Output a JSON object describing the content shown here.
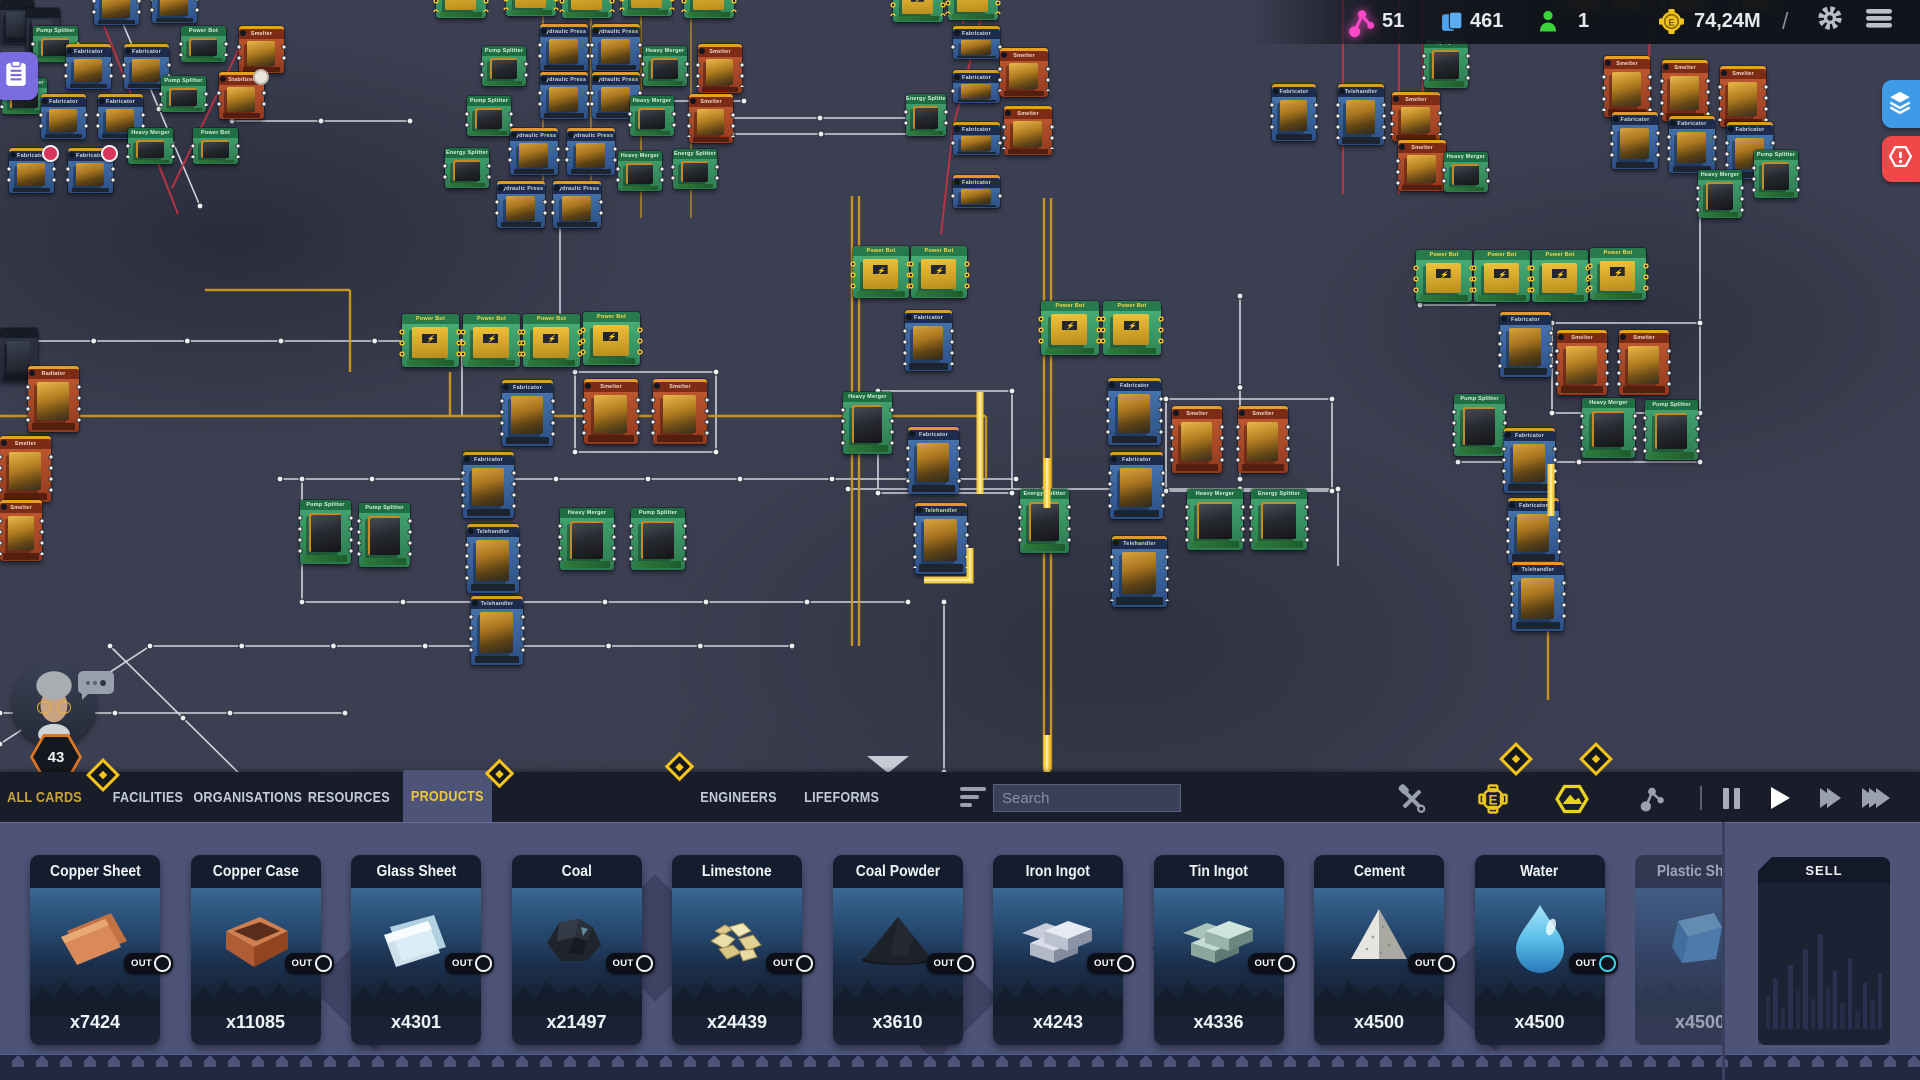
{
  "hud": {
    "connections": "51",
    "cards_count": "461",
    "engineers_count": "1",
    "money": "74,24M",
    "divider": "/"
  },
  "player": {
    "level": "43"
  },
  "tabs": [
    {
      "label": "ALL CARDS",
      "x": 8,
      "w": 74,
      "accent": true
    },
    {
      "label": "FACILITIES",
      "x": 112,
      "w": 72
    },
    {
      "label": "ORGANISATIONS",
      "x": 197,
      "w": 102
    },
    {
      "label": "RESOURCES",
      "x": 308,
      "w": 82
    },
    {
      "label": "PRODUCTS",
      "x": 403,
      "w": 89,
      "selected": true
    },
    {
      "label": "ENGINEERS",
      "x": 699,
      "w": 80
    },
    {
      "label": "LIFEFORMS",
      "x": 802,
      "w": 80
    }
  ],
  "search": {
    "placeholder": "Search"
  },
  "products": {
    "out_label": "OUT",
    "items": [
      {
        "name": "Copper Sheet",
        "count": "x7424",
        "icon": "copper_sheet"
      },
      {
        "name": "Copper Case",
        "count": "x11085",
        "icon": "copper_case"
      },
      {
        "name": "Glass Sheet",
        "count": "x4301",
        "icon": "glass_sheet"
      },
      {
        "name": "Coal",
        "count": "x21497",
        "icon": "coal"
      },
      {
        "name": "Limestone",
        "count": "x24439",
        "icon": "limestone"
      },
      {
        "name": "Coal Powder",
        "count": "x3610",
        "icon": "coal_powder"
      },
      {
        "name": "Iron Ingot",
        "count": "x4243",
        "icon": "iron_ingot"
      },
      {
        "name": "Tin Ingot",
        "count": "x4336",
        "icon": "tin_ingot"
      },
      {
        "name": "Cement",
        "count": "x4500",
        "icon": "cement"
      },
      {
        "name": "Water",
        "count": "x4500",
        "icon": "water",
        "out_accent": "#35d8e8"
      },
      {
        "name": "Plastic Sheet",
        "count": "x4500",
        "icon": "plastic_sheet",
        "faded": true
      }
    ]
  },
  "sell": {
    "label": "SELL",
    "bars": [
      34,
      50,
      22,
      64,
      38,
      80,
      30,
      95,
      42,
      58,
      26,
      70,
      18,
      46,
      30,
      55
    ]
  },
  "board": {
    "diamonds": [
      {
        "x": 100,
        "y": 772,
        "s": 18
      },
      {
        "x": 496,
        "y": 770,
        "s": 15
      },
      {
        "x": 676,
        "y": 763,
        "s": 15
      },
      {
        "x": 1513,
        "y": 756,
        "s": 18
      },
      {
        "x": 1593,
        "y": 756,
        "s": 18
      }
    ],
    "lines": [
      {
        "c": "w",
        "p": "0,341 562,341"
      },
      {
        "c": "w",
        "p": "280,479 1016,479"
      },
      {
        "c": "w",
        "p": "848,489 1338,489"
      },
      {
        "c": "w",
        "p": "302,479 302,602"
      },
      {
        "c": "w",
        "p": "302,602 908,602"
      },
      {
        "c": "w",
        "p": "150,646 792,646"
      },
      {
        "c": "w",
        "p": "0,744 150,646"
      },
      {
        "c": "w",
        "p": "0,713 345,713"
      },
      {
        "c": "w",
        "p": "110,646 256,790"
      },
      {
        "c": "w",
        "p": "232,121 410,121"
      },
      {
        "c": "w",
        "p": "600,101 744,101"
      },
      {
        "c": "w",
        "p": "730,118 910,118"
      },
      {
        "c": "w",
        "p": "732,134 910,134"
      },
      {
        "c": "w",
        "p": "462,341 462,416"
      },
      {
        "c": "w",
        "p": "560,196 560,341"
      },
      {
        "c": "w",
        "p": "944,602 944,772"
      },
      {
        "c": "w",
        "p": "1240,296 1240,479"
      },
      {
        "c": "w",
        "p": "1338,489 1338,566"
      },
      {
        "c": "w",
        "p": "1700,192 1700,323"
      },
      {
        "c": "w",
        "p": "1420,305 1496,305"
      },
      {
        "c": "w",
        "p": "118,12 200,206"
      },
      {
        "c": "w",
        "p": "1458,462 1700,462"
      },
      {
        "c": "w",
        "p": "878,391 1012,391 1012,493 878,493 878,391"
      },
      {
        "c": "w",
        "p": "1166,399 1332,399 1332,491 1166,491 1166,399"
      },
      {
        "c": "w",
        "p": "1552,323 1700,323 1700,413 1552,413 1552,323"
      },
      {
        "c": "w",
        "p": "575,372 716,372 716,452 575,452 575,372"
      },
      {
        "c": "r",
        "p": "94,0 178,214"
      },
      {
        "c": "r",
        "p": "249,28 172,188"
      },
      {
        "c": "r",
        "p": "963,0 963,24"
      },
      {
        "c": "r",
        "p": "986,0 953,128 941,234"
      },
      {
        "c": "r",
        "p": "1343,0 1343,194"
      },
      {
        "c": "r",
        "p": "1399,0 1399,194"
      },
      {
        "c": "r",
        "p": "1423,0 1423,102"
      },
      {
        "c": "r",
        "p": "1652,0 1648,74"
      },
      {
        "c": "y",
        "p": "0,416 986,416"
      },
      {
        "c": "y",
        "p": "1044,198 1044,770"
      },
      {
        "c": "y",
        "p": "1051,198 1051,770"
      },
      {
        "c": "y",
        "p": "852,196 852,646"
      },
      {
        "c": "y",
        "p": "859,196 859,646"
      },
      {
        "c": "yt",
        "p": "543,0 543,218"
      },
      {
        "c": "yt",
        "p": "591,0 591,218"
      },
      {
        "c": "yt",
        "p": "641,0 641,218"
      },
      {
        "c": "yt",
        "p": "691,0 691,218"
      },
      {
        "c": "y",
        "p": "450,372 450,416"
      },
      {
        "c": "y",
        "p": "350,290 350,372"
      },
      {
        "c": "y",
        "p": "205,290 350,290"
      },
      {
        "c": "y",
        "p": "986,416 986,479"
      },
      {
        "c": "y",
        "p": "1548,518 1548,700"
      },
      {
        "c": "glow",
        "p": "980,392 980,494"
      },
      {
        "c": "glow",
        "p": "1047,458 1047,508"
      },
      {
        "c": "glow",
        "p": "1047,735 1047,772"
      },
      {
        "c": "glow",
        "p": "924,580 970,580 970,548"
      },
      {
        "c": "glow",
        "p": "1551,464 1551,516"
      }
    ],
    "cards": [
      {
        "t": "k",
        "x": 0,
        "y": 0,
        "w": 34,
        "h": 44
      },
      {
        "t": "k",
        "x": 26,
        "y": 8,
        "w": 34,
        "h": 44
      },
      {
        "t": "b",
        "x": 94,
        "y": -20,
        "w": 45,
        "h": 42
      },
      {
        "t": "b",
        "x": 152,
        "y": -22,
        "w": 45,
        "h": 42
      },
      {
        "t": "g",
        "x": 33,
        "y": 26,
        "w": 45,
        "h": 36,
        "l": "Pump Splitter"
      },
      {
        "t": "b",
        "x": 66,
        "y": 44,
        "w": 45,
        "h": 42
      },
      {
        "t": "b",
        "x": 124,
        "y": 44,
        "w": 45,
        "h": 42
      },
      {
        "t": "g",
        "x": 181,
        "y": 26,
        "w": 45,
        "h": 36,
        "l": "Power Bot"
      },
      {
        "t": "o",
        "x": 239,
        "y": 26,
        "w": 45,
        "h": 44
      },
      {
        "t": "g",
        "x": 2,
        "y": 78,
        "w": 45,
        "h": 36,
        "l": "Heavy Merger"
      },
      {
        "t": "b",
        "x": 41,
        "y": 94,
        "w": 45,
        "h": 42
      },
      {
        "t": "b",
        "x": 98,
        "y": 94,
        "w": 45,
        "h": 42
      },
      {
        "t": "g",
        "x": 161,
        "y": 76,
        "w": 45,
        "h": 36,
        "l": "Pump Splitter"
      },
      {
        "t": "o",
        "x": 219,
        "y": 72,
        "w": 45,
        "h": 44,
        "b": "g",
        "l": "Stabilizer"
      },
      {
        "t": "b",
        "x": 9,
        "y": 148,
        "w": 45,
        "h": 42,
        "b": "r"
      },
      {
        "t": "b",
        "x": 68,
        "y": 148,
        "w": 45,
        "h": 42,
        "b": "r"
      },
      {
        "t": "g",
        "x": 128,
        "y": 128,
        "w": 45,
        "h": 36,
        "l": "Heavy Merger"
      },
      {
        "t": "g",
        "x": 193,
        "y": 128,
        "w": 45,
        "h": 36,
        "l": "Power Bot"
      },
      {
        "t": "gp",
        "x": 436,
        "y": -28,
        "w": 50,
        "h": 46
      },
      {
        "t": "gp",
        "x": 506,
        "y": -30,
        "w": 50,
        "h": 46
      },
      {
        "t": "gp",
        "x": 562,
        "y": -28,
        "w": 50,
        "h": 46
      },
      {
        "t": "gp",
        "x": 622,
        "y": -30,
        "w": 50,
        "h": 46
      },
      {
        "t": "gp",
        "x": 684,
        "y": -28,
        "w": 50,
        "h": 46
      },
      {
        "t": "b",
        "x": 540,
        "y": 24,
        "w": 48,
        "h": 44,
        "l": "Hydraulic Press"
      },
      {
        "t": "b",
        "x": 592,
        "y": 24,
        "w": 48,
        "h": 44,
        "l": "Hydraulic Press"
      },
      {
        "t": "g",
        "x": 482,
        "y": 46,
        "w": 44,
        "h": 40,
        "l": "Pump Splitter"
      },
      {
        "t": "g",
        "x": 643,
        "y": 46,
        "w": 44,
        "h": 40,
        "l": "Heavy Merger"
      },
      {
        "t": "o",
        "x": 698,
        "y": 44,
        "w": 44,
        "h": 46
      },
      {
        "t": "b",
        "x": 540,
        "y": 72,
        "w": 48,
        "h": 44,
        "l": "Hydraulic Press"
      },
      {
        "t": "b",
        "x": 592,
        "y": 72,
        "w": 48,
        "h": 44,
        "l": "Hydraulic Press"
      },
      {
        "t": "g",
        "x": 467,
        "y": 96,
        "w": 44,
        "h": 40,
        "l": "Pump Splitter"
      },
      {
        "t": "g",
        "x": 630,
        "y": 96,
        "w": 44,
        "h": 40,
        "l": "Heavy Merger"
      },
      {
        "t": "o",
        "x": 689,
        "y": 94,
        "w": 44,
        "h": 46
      },
      {
        "t": "b",
        "x": 510,
        "y": 128,
        "w": 48,
        "h": 44,
        "l": "Hydraulic Press"
      },
      {
        "t": "b",
        "x": 567,
        "y": 128,
        "w": 48,
        "h": 44,
        "l": "Hydraulic Press"
      },
      {
        "t": "g",
        "x": 445,
        "y": 148,
        "w": 44,
        "h": 40
      },
      {
        "t": "g",
        "x": 618,
        "y": 151,
        "w": 44,
        "h": 40,
        "l": "Heavy Merger"
      },
      {
        "t": "g",
        "x": 673,
        "y": 149,
        "w": 44,
        "h": 40
      },
      {
        "t": "b",
        "x": 497,
        "y": 181,
        "w": 48,
        "h": 44,
        "l": "Hydraulic Press"
      },
      {
        "t": "b",
        "x": 553,
        "y": 181,
        "w": 48,
        "h": 44,
        "l": "Hydraulic Press"
      },
      {
        "t": "gp",
        "x": 893,
        "y": -24,
        "w": 50,
        "h": 46
      },
      {
        "t": "gp",
        "x": 948,
        "y": -26,
        "w": 50,
        "h": 46
      },
      {
        "t": "g",
        "x": 906,
        "y": 94,
        "w": 40,
        "h": 42
      },
      {
        "t": "b",
        "x": 953,
        "y": 26,
        "w": 47,
        "h": 30
      },
      {
        "t": "b",
        "x": 953,
        "y": 70,
        "w": 47,
        "h": 30
      },
      {
        "t": "b",
        "x": 953,
        "y": 122,
        "w": 47,
        "h": 30
      },
      {
        "t": "b",
        "x": 953,
        "y": 175,
        "w": 47,
        "h": 30
      },
      {
        "t": "o",
        "x": 1000,
        "y": 48,
        "w": 48,
        "h": 46
      },
      {
        "t": "o",
        "x": 1004,
        "y": 106,
        "w": 48,
        "h": 46
      },
      {
        "t": "b",
        "x": 1338,
        "y": 84,
        "w": 46,
        "h": 58,
        "l": "Telehandler"
      },
      {
        "t": "o",
        "x": 1392,
        "y": 92,
        "w": 48,
        "h": 46
      },
      {
        "t": "o",
        "x": 1398,
        "y": 140,
        "w": 48,
        "h": 48
      },
      {
        "t": "g",
        "x": 1424,
        "y": 38,
        "w": 44,
        "h": 50,
        "l": "Pump Splitter"
      },
      {
        "t": "g",
        "x": 1444,
        "y": 152,
        "w": 44,
        "h": 40,
        "l": "Heavy Merger"
      },
      {
        "t": "gp",
        "x": 1560,
        "y": -26,
        "w": 48,
        "h": 46
      },
      {
        "t": "gp",
        "x": 1602,
        "y": -28,
        "w": 48,
        "h": 46
      },
      {
        "t": "gp",
        "x": 1662,
        "y": -26,
        "w": 48,
        "h": 46
      },
      {
        "t": "gp",
        "x": 1732,
        "y": -28,
        "w": 48,
        "h": 46
      },
      {
        "t": "b",
        "x": 1272,
        "y": 84,
        "w": 44,
        "h": 54
      },
      {
        "t": "o",
        "x": 1604,
        "y": 56,
        "w": 46,
        "h": 58
      },
      {
        "t": "o",
        "x": 1662,
        "y": 60,
        "w": 46,
        "h": 58
      },
      {
        "t": "o",
        "x": 1720,
        "y": 66,
        "w": 46,
        "h": 58
      },
      {
        "t": "b",
        "x": 1612,
        "y": 112,
        "w": 46,
        "h": 54
      },
      {
        "t": "b",
        "x": 1669,
        "y": 116,
        "w": 46,
        "h": 54
      },
      {
        "t": "b",
        "x": 1727,
        "y": 122,
        "w": 46,
        "h": 54
      },
      {
        "t": "g",
        "x": 1698,
        "y": 170,
        "w": 44,
        "h": 48,
        "l": "Heavy Merger"
      },
      {
        "t": "g",
        "x": 1754,
        "y": 150,
        "w": 44,
        "h": 48,
        "l": "Pump Splitter"
      },
      {
        "t": "gp",
        "x": 402,
        "y": 314,
        "w": 57,
        "h": 53
      },
      {
        "t": "gp",
        "x": 463,
        "y": 314,
        "w": 57,
        "h": 53
      },
      {
        "t": "gp",
        "x": 523,
        "y": 314,
        "w": 57,
        "h": 53
      },
      {
        "t": "gp",
        "x": 583,
        "y": 312,
        "w": 57,
        "h": 53
      },
      {
        "t": "b",
        "x": 502,
        "y": 380,
        "w": 51,
        "h": 63
      },
      {
        "t": "o",
        "x": 584,
        "y": 379,
        "w": 54,
        "h": 62
      },
      {
        "t": "o",
        "x": 653,
        "y": 379,
        "w": 54,
        "h": 62
      },
      {
        "t": "b",
        "x": 463,
        "y": 452,
        "w": 51,
        "h": 63
      },
      {
        "t": "b",
        "x": 467,
        "y": 524,
        "w": 52,
        "h": 66,
        "l": "Telehandler"
      },
      {
        "t": "b",
        "x": 471,
        "y": 596,
        "w": 52,
        "h": 66,
        "l": "Telehandler"
      },
      {
        "t": "g",
        "x": 300,
        "y": 500,
        "w": 51,
        "h": 64,
        "l": "Pump Splitter"
      },
      {
        "t": "g",
        "x": 359,
        "y": 503,
        "w": 51,
        "h": 64,
        "l": "Pump Splitter"
      },
      {
        "t": "g",
        "x": 560,
        "y": 508,
        "w": 54,
        "h": 62,
        "l": "Heavy Merger"
      },
      {
        "t": "g",
        "x": 631,
        "y": 508,
        "w": 54,
        "h": 62,
        "l": "Pump Splitter"
      },
      {
        "t": "k",
        "x": 0,
        "y": 328,
        "w": 38,
        "h": 54
      },
      {
        "t": "o",
        "x": 28,
        "y": 366,
        "w": 51,
        "h": 63,
        "l": "Radiator"
      },
      {
        "t": "o",
        "x": 0,
        "y": 436,
        "w": 51,
        "h": 63
      },
      {
        "t": "o",
        "x": 0,
        "y": 500,
        "w": 42,
        "h": 58
      },
      {
        "t": "gp",
        "x": 853,
        "y": 246,
        "w": 56,
        "h": 52
      },
      {
        "t": "gp",
        "x": 911,
        "y": 246,
        "w": 56,
        "h": 52
      },
      {
        "t": "gp",
        "x": 1041,
        "y": 301,
        "w": 58,
        "h": 54
      },
      {
        "t": "gp",
        "x": 1103,
        "y": 301,
        "w": 58,
        "h": 54
      },
      {
        "t": "b",
        "x": 905,
        "y": 310,
        "w": 47,
        "h": 58
      },
      {
        "t": "g",
        "x": 843,
        "y": 392,
        "w": 49,
        "h": 62,
        "l": "Heavy Merger"
      },
      {
        "t": "b",
        "x": 908,
        "y": 427,
        "w": 51,
        "h": 64
      },
      {
        "t": "b",
        "x": 915,
        "y": 503,
        "w": 52,
        "h": 68,
        "l": "Telehandler"
      },
      {
        "t": "b",
        "x": 1108,
        "y": 378,
        "w": 53,
        "h": 64
      },
      {
        "t": "o",
        "x": 1172,
        "y": 406,
        "w": 50,
        "h": 64
      },
      {
        "t": "o",
        "x": 1238,
        "y": 406,
        "w": 50,
        "h": 64
      },
      {
        "t": "b",
        "x": 1110,
        "y": 452,
        "w": 53,
        "h": 64
      },
      {
        "t": "g",
        "x": 1020,
        "y": 489,
        "w": 49,
        "h": 64
      },
      {
        "t": "g",
        "x": 1187,
        "y": 489,
        "w": 56,
        "h": 61,
        "l": "Heavy Merger"
      },
      {
        "t": "g",
        "x": 1251,
        "y": 489,
        "w": 56,
        "h": 61
      },
      {
        "t": "b",
        "x": 1112,
        "y": 536,
        "w": 55,
        "h": 68,
        "l": "Telehandler"
      },
      {
        "t": "gp",
        "x": 1416,
        "y": 250,
        "w": 56,
        "h": 52
      },
      {
        "t": "gp",
        "x": 1474,
        "y": 250,
        "w": 56,
        "h": 52
      },
      {
        "t": "gp",
        "x": 1532,
        "y": 250,
        "w": 56,
        "h": 52
      },
      {
        "t": "gp",
        "x": 1590,
        "y": 248,
        "w": 56,
        "h": 52
      },
      {
        "t": "b",
        "x": 1500,
        "y": 312,
        "w": 51,
        "h": 62
      },
      {
        "t": "o",
        "x": 1557,
        "y": 330,
        "w": 50,
        "h": 62
      },
      {
        "t": "o",
        "x": 1619,
        "y": 330,
        "w": 50,
        "h": 62
      },
      {
        "t": "g",
        "x": 1454,
        "y": 394,
        "w": 51,
        "h": 62,
        "l": "Pump Splitter"
      },
      {
        "t": "g",
        "x": 1582,
        "y": 398,
        "w": 53,
        "h": 60,
        "l": "Heavy Merger"
      },
      {
        "t": "g",
        "x": 1645,
        "y": 400,
        "w": 53,
        "h": 60,
        "l": "Pump Splitter"
      },
      {
        "t": "b",
        "x": 1504,
        "y": 428,
        "w": 51,
        "h": 62
      },
      {
        "t": "b",
        "x": 1508,
        "y": 498,
        "w": 51,
        "h": 62
      },
      {
        "t": "b",
        "x": 1512,
        "y": 562,
        "w": 52,
        "h": 66,
        "l": "Telehandler"
      }
    ],
    "card_default_labels": {
      "gp": "Power Bot",
      "g": "Energy Splitter",
      "b": "Fabricator",
      "o": "Smelter",
      "k": ""
    }
  }
}
